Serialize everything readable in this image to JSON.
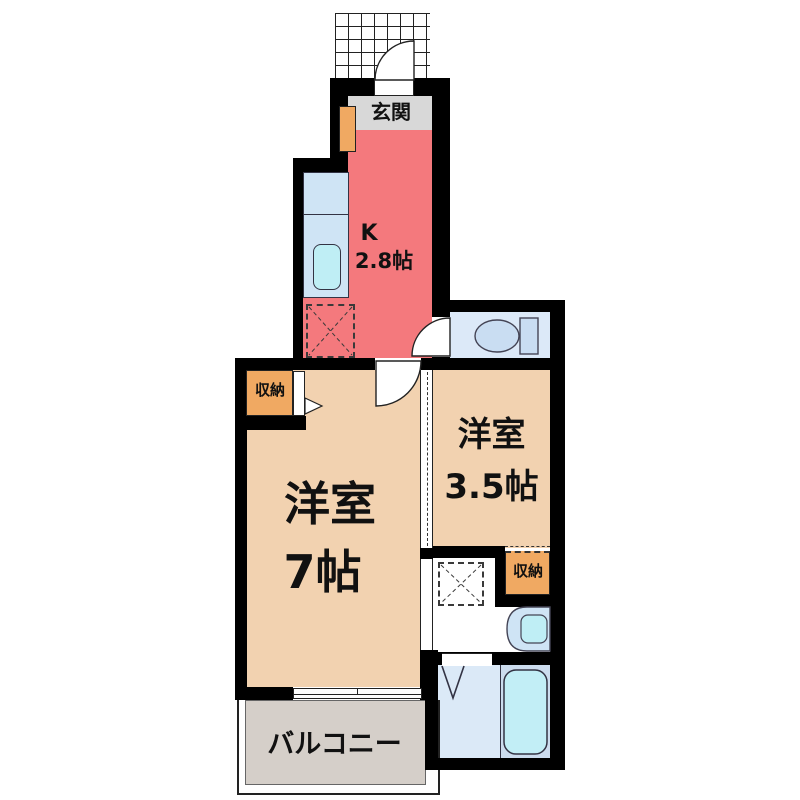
{
  "plan": {
    "type": "apartment-floor-plan",
    "rooms": {
      "genkan": {
        "label": "玄関"
      },
      "kitchen": {
        "label": "K",
        "size": "2.8帖"
      },
      "room7": {
        "label": "洋室",
        "size": "7帖"
      },
      "room35": {
        "label": "洋室",
        "size": "3.5帖"
      },
      "balcony": {
        "label": "バルコニー"
      },
      "closet_upper": {
        "label": "収納"
      },
      "closet_lower": {
        "label": "収納"
      }
    },
    "fixtures": [
      "entrance-door",
      "shoe-cabinet",
      "kitchen-counter",
      "kitchen-sink",
      "refrigerator-space",
      "toilet",
      "interior-door",
      "sliding-door",
      "closet-bifold-door",
      "washing-machine-space",
      "washbasin",
      "bathtub",
      "bath-folding-door",
      "balcony-window"
    ],
    "colors": {
      "wall": "#000000",
      "kitchen_floor": "#f4797d",
      "room_floor": "#f2d2b0",
      "genkan_floor": "#d8d8d8",
      "closet": "#f0a962",
      "balcony_floor": "#d5cfc9",
      "fixture_blue": "#cfe4f5",
      "fixture_cyan": "#bfeef5",
      "toilet_room": "#dce9f8"
    }
  }
}
